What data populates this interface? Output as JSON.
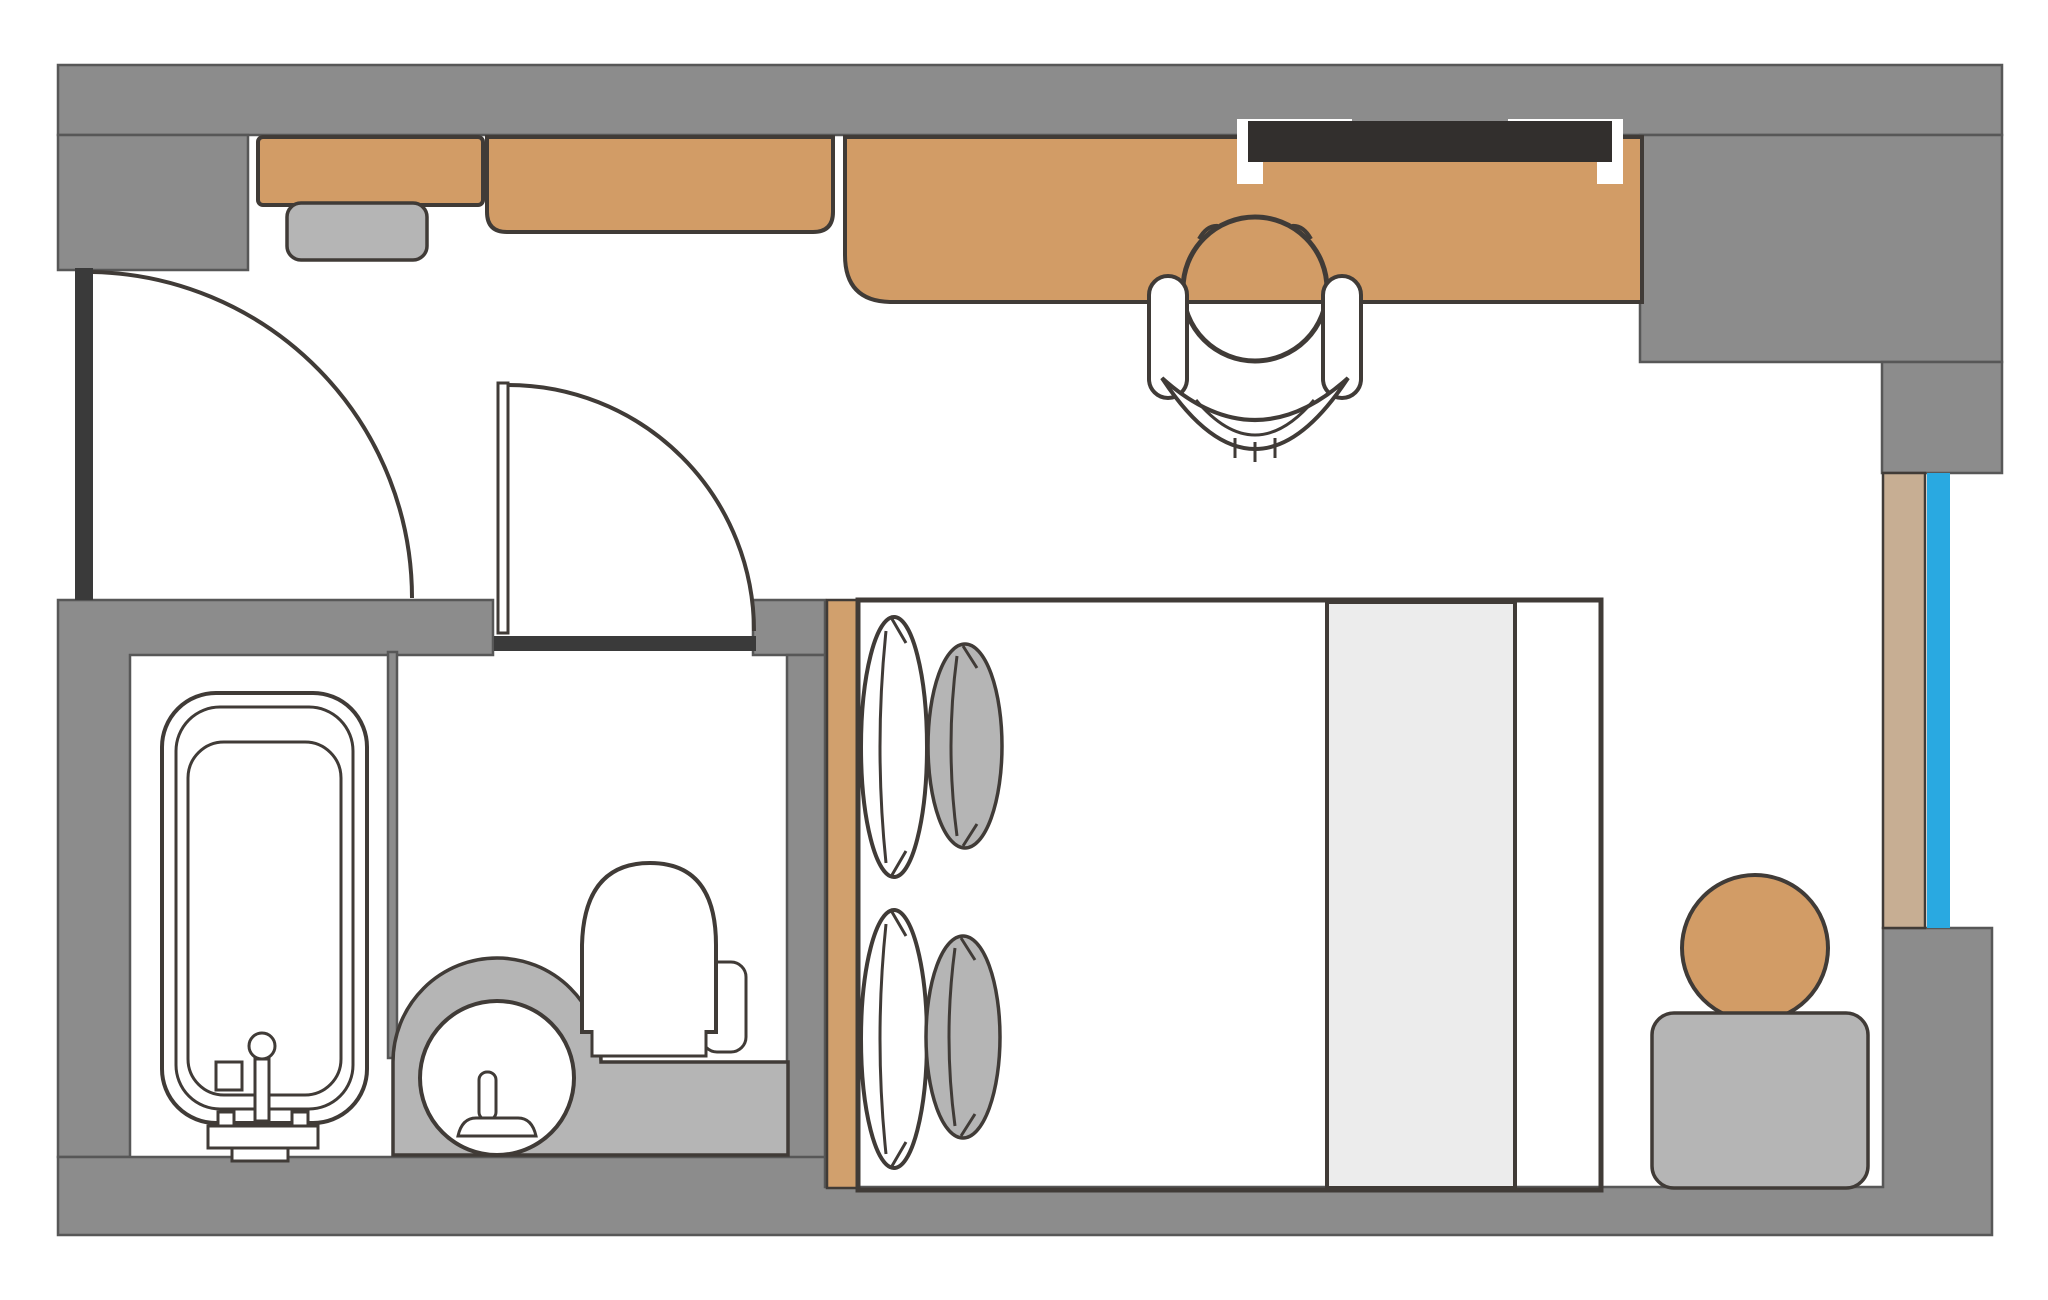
{
  "floorplan": {
    "type": "hotel-room-floor-plan",
    "colors": {
      "wall": "#8c8c8c",
      "wall_outline": "#575757",
      "door_dark": "#3a3a3a",
      "outline": "#403b37",
      "furniture_tan": "#d29c66",
      "headboard_tan": "#d1a06d",
      "window_sill_beige": "#c7ae93",
      "window_blue": "#29a9e1",
      "light_gray": "#b5b5b5",
      "runner_gray": "#ececec",
      "tv_dark": "#322f2d",
      "white": "#ffffff"
    },
    "rooms": [
      {
        "name": "entry-hall"
      },
      {
        "name": "bathroom"
      },
      {
        "name": "bedroom-living-area"
      }
    ],
    "items": [
      {
        "name": "entry-door"
      },
      {
        "name": "bathroom-door"
      },
      {
        "name": "wardrobe"
      },
      {
        "name": "luggage-rack"
      },
      {
        "name": "dresser"
      },
      {
        "name": "desk"
      },
      {
        "name": "tv"
      },
      {
        "name": "desk-chair"
      },
      {
        "name": "bathtub"
      },
      {
        "name": "bath-faucet"
      },
      {
        "name": "washbasin"
      },
      {
        "name": "vanity-counter"
      },
      {
        "name": "toilet"
      },
      {
        "name": "double-bed"
      },
      {
        "name": "bed-headboard"
      },
      {
        "name": "bed-runner"
      },
      {
        "name": "pillow-white-top"
      },
      {
        "name": "pillow-gray-top"
      },
      {
        "name": "pillow-white-bottom"
      },
      {
        "name": "pillow-gray-bottom"
      },
      {
        "name": "window"
      },
      {
        "name": "window-sill"
      },
      {
        "name": "side-table"
      },
      {
        "name": "stool"
      }
    ]
  }
}
